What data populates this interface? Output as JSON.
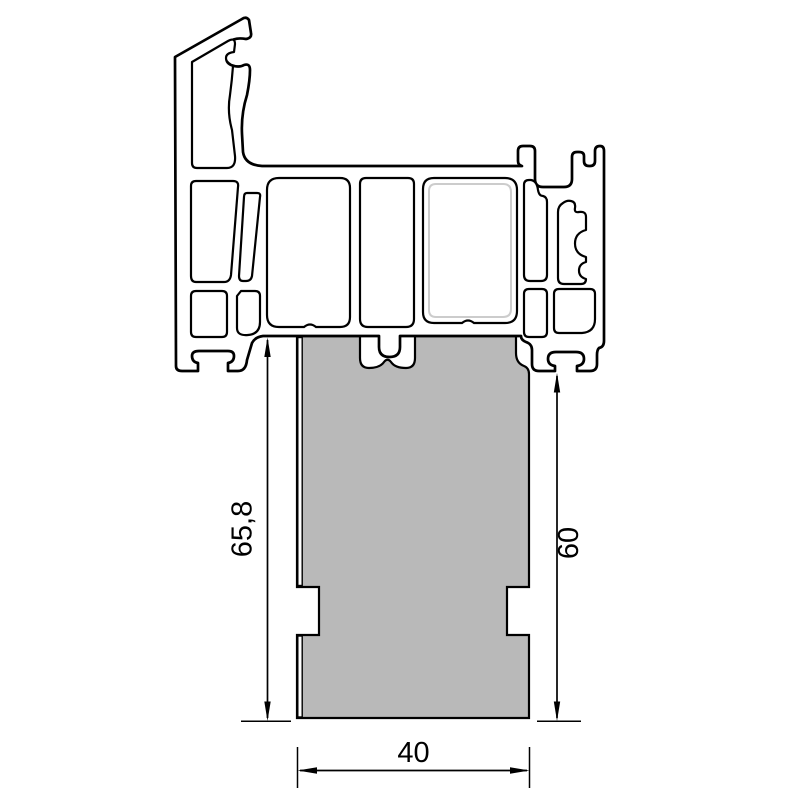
{
  "drawing": {
    "type": "technical-cross-section",
    "parts": {
      "profile": "pvc-window-sill-profile",
      "infill_block": "extension-infill-block"
    }
  },
  "dimensions": {
    "height_total": {
      "label": "65,8"
    },
    "height_right": {
      "label": "60"
    },
    "width_bottom": {
      "label": "40"
    }
  },
  "colors": {
    "outline": "#000000",
    "infill_gray": "#b9b9b9",
    "liner_gray": "#cccccc",
    "background": "#ffffff"
  }
}
